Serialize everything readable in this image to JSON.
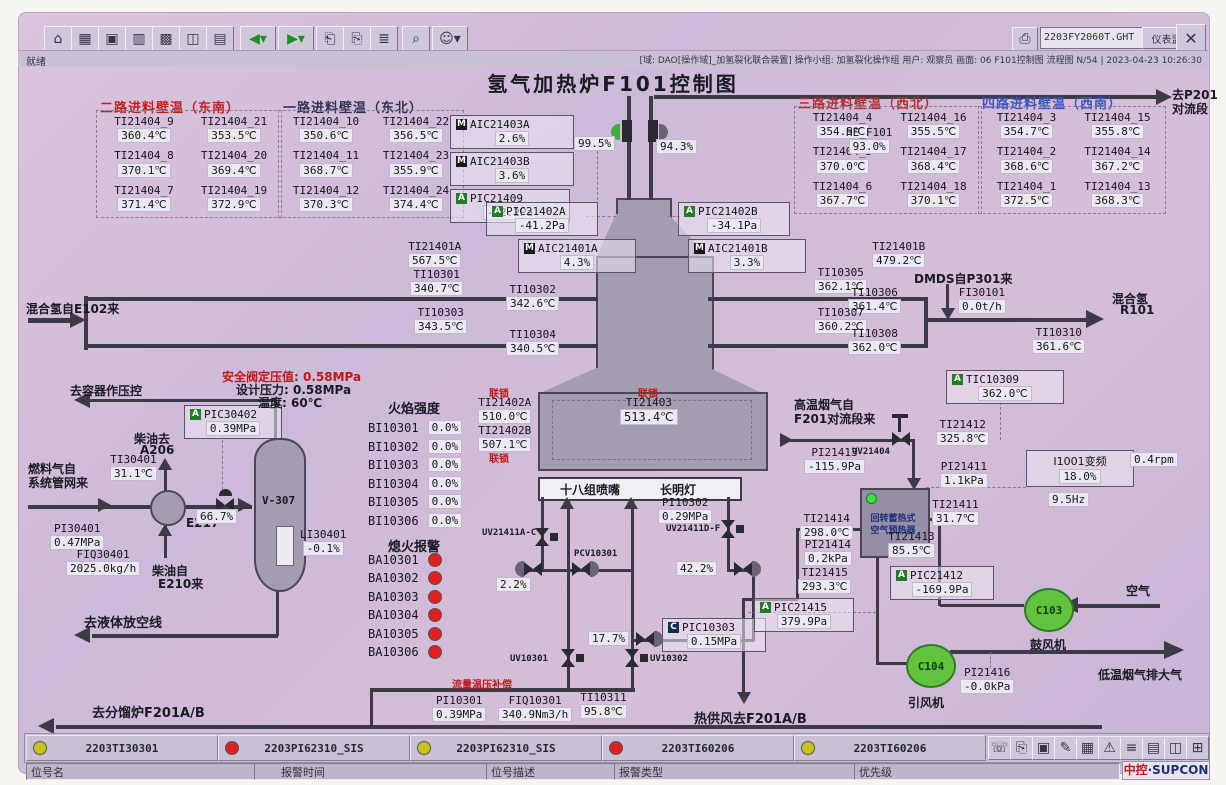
{
  "window": {
    "file": "2203FY2060T.GHT",
    "monitor_btn": "仪表监听",
    "status_left": "就绪",
    "status_right": "[域: DAO[操作域]_加氢裂化联合装置]  操作小组: 加氢裂化操作组  用户: 观察员  画面: 06 F101控制图  流程图 N/54 | 2023-04-23 10:26:30",
    "toolbar_icons": [
      "⌂",
      "▦",
      "▣",
      "▥",
      "▩",
      "◫",
      "▤",
      "◀",
      "▶",
      "⎗",
      "⎘",
      "≣",
      "⌕",
      "☺"
    ],
    "tray_icons": [
      "☏",
      "⎘",
      "▣",
      "✎",
      "▦",
      "⚠",
      "≡",
      "▤",
      "◫",
      "⊞"
    ]
  },
  "title": "氢气加热炉F101控制图",
  "wall": {
    "p2": {
      "title": "二路进料壁温（东南）",
      "cells": [
        {
          "t": "TI21404_9",
          "v": "360.4℃"
        },
        {
          "t": "TI21404_21",
          "v": "353.5℃"
        },
        {
          "t": "TI21404_8",
          "v": "370.1℃"
        },
        {
          "t": "TI21404_20",
          "v": "369.4℃"
        },
        {
          "t": "TI21404_7",
          "v": "371.4℃"
        },
        {
          "t": "TI21404_19",
          "v": "372.9℃"
        }
      ]
    },
    "p1": {
      "title": "一路进料壁温（东北）",
      "cells": [
        {
          "t": "TI21404_10",
          "v": "350.6℃"
        },
        {
          "t": "TI21404_22",
          "v": "356.5℃"
        },
        {
          "t": "TI21404_11",
          "v": "368.7℃"
        },
        {
          "t": "TI21404_23",
          "v": "355.9℃"
        },
        {
          "t": "TI21404_12",
          "v": "370.3℃"
        },
        {
          "t": "TI21404_24",
          "v": "374.4℃"
        }
      ]
    },
    "p3": {
      "title": "三路进料壁温（西北）",
      "cells": [
        {
          "t": "TI21404_4",
          "v": "354.5℃"
        },
        {
          "t": "TI21404_16",
          "v": "355.5℃"
        },
        {
          "t": "TI21404_5",
          "v": "370.0℃"
        },
        {
          "t": "TI21404_17",
          "v": "368.4℃"
        },
        {
          "t": "TI21404_6",
          "v": "367.7℃"
        },
        {
          "t": "TI21404_18",
          "v": "370.1℃"
        }
      ]
    },
    "p4": {
      "title": "四路进料壁温（西南）",
      "cells": [
        {
          "t": "TI21404_3",
          "v": "354.7℃"
        },
        {
          "t": "TI21404_15",
          "v": "355.8℃"
        },
        {
          "t": "TI21404_2",
          "v": "368.6℃"
        },
        {
          "t": "TI21404_14",
          "v": "367.2℃"
        },
        {
          "t": "TI21404_1",
          "v": "372.5℃"
        },
        {
          "t": "TI21404_13",
          "v": "368.3℃"
        }
      ]
    }
  },
  "pts": {
    "TI21401A": {
      "t": "TI21401A",
      "v": "567.5℃"
    },
    "TI10301": {
      "t": "TI10301",
      "v": "340.7℃"
    },
    "TI10302": {
      "t": "TI10302",
      "v": "342.6℃"
    },
    "TI10303": {
      "t": "TI10303",
      "v": "343.5℃"
    },
    "TI10304": {
      "t": "TI10304",
      "v": "340.5℃"
    },
    "TI21401B": {
      "t": "TI21401B",
      "v": "479.2℃"
    },
    "TI10305": {
      "t": "TI10305",
      "v": "362.1℃"
    },
    "TI10306": {
      "t": "TI10306",
      "v": "361.4℃"
    },
    "TI10307": {
      "t": "TI10307",
      "v": "360.2℃"
    },
    "TI10308": {
      "t": "TI10308",
      "v": "362.0℃"
    },
    "FI30101": {
      "t": "FI30101",
      "v": "0.0t/h"
    },
    "TI10310": {
      "t": "TI10310",
      "v": "361.6℃"
    },
    "HE_F101": {
      "t": "HE_F101",
      "v": "93.0%"
    },
    "TI21402A": {
      "t": "TI21402A",
      "v": "510.0℃"
    },
    "TI21402B": {
      "t": "TI21402B",
      "v": "507.1℃"
    },
    "TI21403": {
      "t": "TI21403",
      "v": "513.4℃"
    },
    "TI30401": {
      "t": "TI30401",
      "v": "31.1℃"
    },
    "PI30401": {
      "t": "PI30401",
      "v": "0.47MPa"
    },
    "FIQ30401": {
      "t": "FIQ30401",
      "v": "2025.0kg/h"
    },
    "LI30401": {
      "t": "LI30401",
      "v": "-0.1%"
    },
    "PI10302": {
      "t": "PI10302",
      "v": "0.29MPa"
    },
    "PI10301": {
      "t": "PI10301",
      "v": "0.39MPa"
    },
    "FIQ10301": {
      "t": "FIQ10301",
      "v": "340.9Nm3/h"
    },
    "TI10311": {
      "t": "TI10311",
      "v": "95.8℃"
    },
    "TI21412": {
      "t": "TI21412",
      "v": "325.8℃"
    },
    "PI21413": {
      "t": "PI21413",
      "v": "-115.9Pa"
    },
    "PI21411": {
      "t": "PI21411",
      "v": "1.1kPa"
    },
    "TI21411": {
      "t": "TI21411",
      "v": "31.7℃"
    },
    "TI21414": {
      "t": "TI21414",
      "v": "298.0℃"
    },
    "PI21414": {
      "t": "PI21414",
      "v": "0.2kPa"
    },
    "TI21415": {
      "t": "TI21415",
      "v": "293.3℃"
    },
    "TI21413": {
      "t": "TI21413",
      "v": "85.5℃"
    },
    "PI21416": {
      "t": "PI21416",
      "v": "-0.0kPa"
    }
  },
  "inst": {
    "AIC21403A": {
      "b": "M",
      "t": "AIC21403A",
      "v": "2.6%"
    },
    "AIC21403B": {
      "b": "M",
      "t": "AIC21403B",
      "v": "3.6%"
    },
    "PIC21409": {
      "b": "A",
      "t": "PIC21409",
      "v": "-42.2Pa"
    },
    "PIC21402A": {
      "b": "A",
      "t": "PIC21402A",
      "v": "-41.2Pa"
    },
    "PIC21402B": {
      "b": "A",
      "t": "PIC21402B",
      "v": "-34.1Pa"
    },
    "AIC21401A": {
      "b": "M",
      "t": "AIC21401A",
      "v": "4.3%"
    },
    "AIC21401B": {
      "b": "M",
      "t": "AIC21401B",
      "v": "3.3%"
    },
    "TIC10309": {
      "b": "A",
      "t": "TIC10309",
      "v": "362.0℃"
    },
    "PIC30402": {
      "b": "A",
      "t": "PIC30402",
      "v": "0.39MPa"
    },
    "PIC10303": {
      "b": "C",
      "t": "PIC10303",
      "v": "0.15MPa"
    },
    "PIC21412": {
      "b": "A",
      "t": "PIC21412",
      "v": "-169.9Pa"
    },
    "PIC21415": {
      "b": "A",
      "t": "PIC21415",
      "v": "379.9Pa"
    }
  },
  "vfd": {
    "t": "I1001变频",
    "pct": "18.0%",
    "hz": "9.5Hz",
    "rpm": "0.4rpm"
  },
  "vp": {
    "stack_l": "99.5%",
    "stack_r": "94.3%",
    "fuel": "66.7%",
    "burner": "2.2%",
    "pilot": "42.2%",
    "pilot2": "17.7%"
  },
  "lb": {
    "p201a": "去P201",
    "p201b": "对流段",
    "mix_in": "混合氢自E102来",
    "dmds": "DMDS自P301来",
    "mixa": "混合氢",
    "mixb": "R101",
    "safe1": "安全阀定压值: 0.58MPa",
    "safe2": "设计压力: 0.58MPa",
    "safe3": "温度: 60℃",
    "tovessel": "去容器作压控",
    "da": "柴油去",
    "db": "A206",
    "fa": "燃料气自",
    "fb": "系统管网来",
    "dfa": "柴油自",
    "dfb": "E210来",
    "v307": "V-307",
    "e217": "E217",
    "vent": "去液体放空线",
    "frac": "去分馏炉F201A/B",
    "interlock": "联锁",
    "nozzle": "十八组喷嘴",
    "pilotlamp": "长明灯",
    "comp": "流量温压补偿",
    "hotair": "热供风去F201A/B",
    "fluea": "高温烟气自",
    "flueb": "F201对流段来",
    "pha": "回转蓄热式",
    "phb": "空气预热器",
    "blower": "鼓风机",
    "idfan": "引风机",
    "air": "空气",
    "flueout": "低温烟气排大气",
    "c103": "C103",
    "c104": "C104",
    "uv21404": "UV21404",
    "uv10301": "UV10301",
    "uv10302": "UV10302",
    "uvac": "UV21411A-C",
    "uvdf": "UV21411D-F",
    "pcv": "PCV10301"
  },
  "bi": {
    "title": "火焰强度",
    "rows": [
      {
        "t": "BI10301",
        "v": "0.0%"
      },
      {
        "t": "BI10302",
        "v": "0.0%"
      },
      {
        "t": "BI10303",
        "v": "0.0%"
      },
      {
        "t": "BI10304",
        "v": "0.0%"
      },
      {
        "t": "BI10305",
        "v": "0.0%"
      },
      {
        "t": "BI10306",
        "v": "0.0%"
      }
    ]
  },
  "ba": {
    "title": "熄火报警",
    "rows": [
      "BA10301",
      "BA10302",
      "BA10303",
      "BA10304",
      "BA10305",
      "BA10306"
    ]
  },
  "alarm": {
    "rows": [
      {
        "c": "y",
        "t": "2203TI30301"
      },
      {
        "c": "r",
        "t": "2203PI62310_SIS"
      },
      {
        "c": "y",
        "t": "2203PI62310_SIS"
      },
      {
        "c": "r",
        "t": "2203TI60206"
      },
      {
        "c": "y",
        "t": "2203TI60206"
      }
    ],
    "fields": [
      "位号名",
      "报警时间",
      "位号描述",
      "报警类型",
      "优先级"
    ],
    "logo1": "中控",
    "logo2": "·SUPCON"
  },
  "colors": {
    "screen": "#cdb9d9",
    "red": "#c01818",
    "alarm_red": "#e02020",
    "alarm_yellow": "#c9c21f",
    "pipe": "#3b3a45",
    "furnace": "#a59cb1",
    "green": "#3fae3f"
  }
}
